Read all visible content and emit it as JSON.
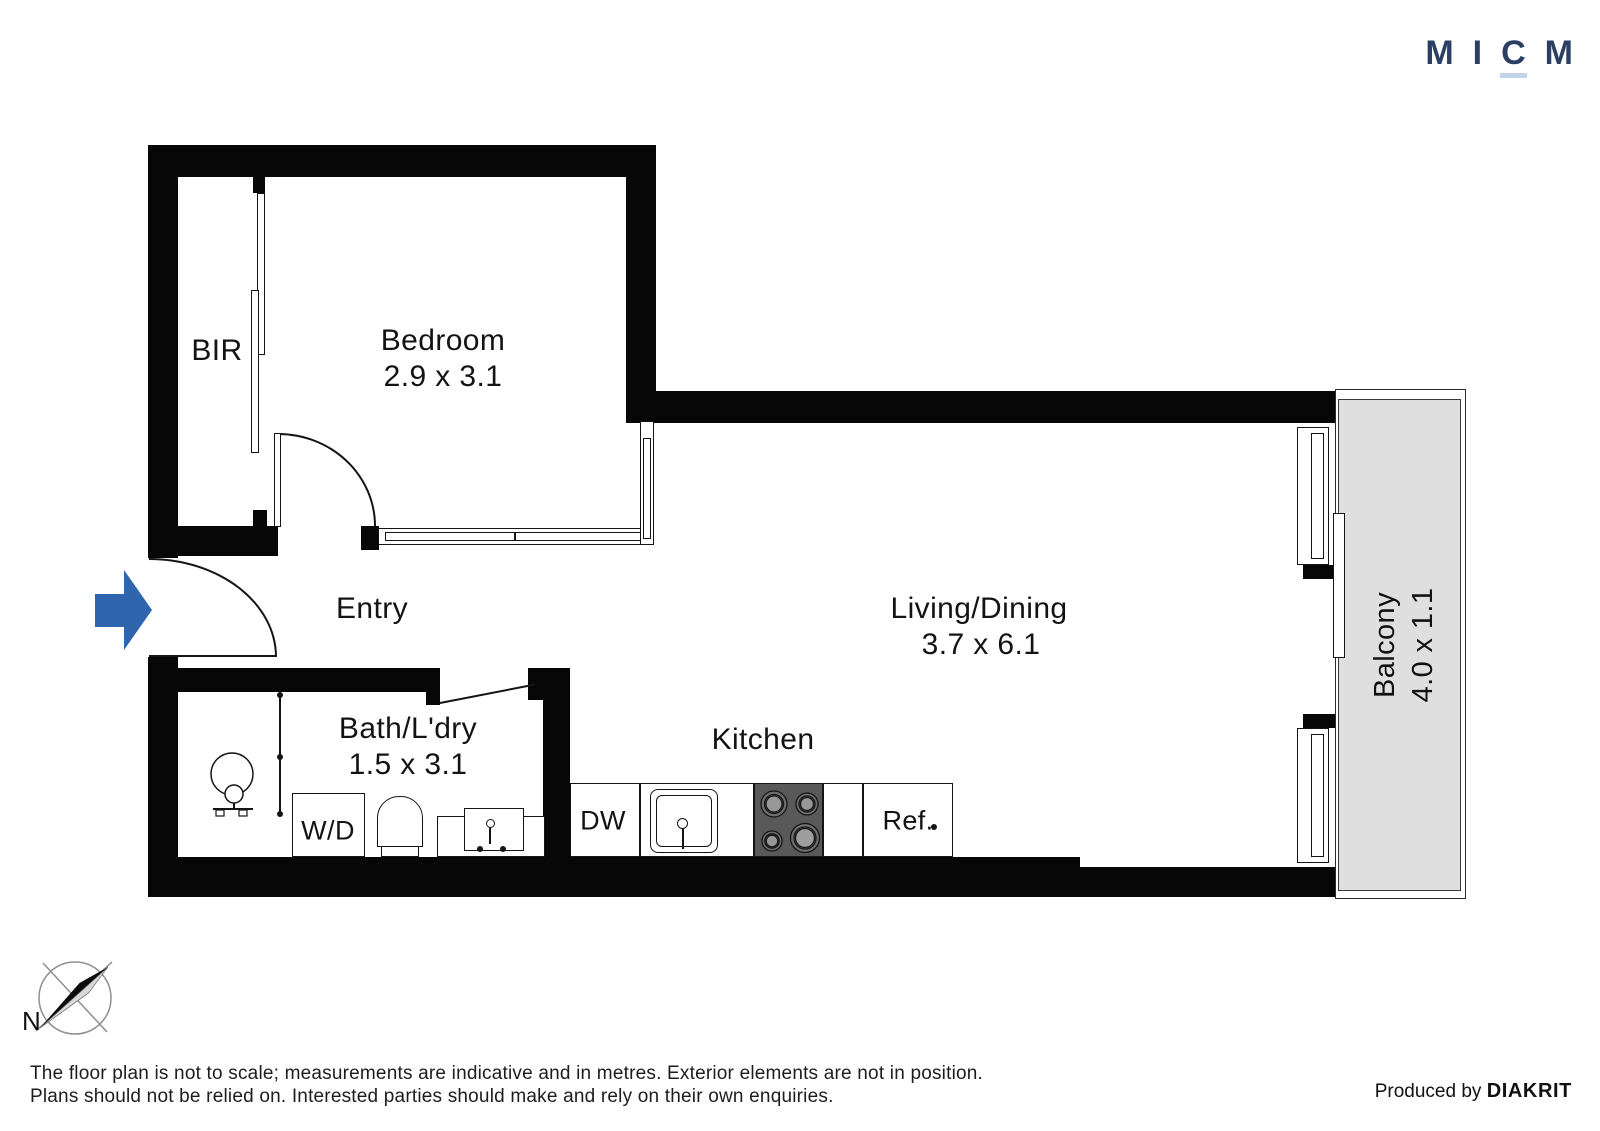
{
  "brand": {
    "logo_letters": [
      "M",
      "I",
      "C",
      "M"
    ],
    "logo_color": "#2b3f63",
    "logo_underline_color": "#c3d4ea"
  },
  "rooms": {
    "bir": {
      "name": "BIR"
    },
    "bedroom": {
      "name": "Bedroom",
      "dims": "2.9 x 3.1"
    },
    "entry": {
      "name": "Entry"
    },
    "living": {
      "name": "Living/Dining",
      "dims": "3.7 x 6.1"
    },
    "bath": {
      "name": "Bath/L'dry",
      "dims": "1.5 x 3.1"
    },
    "kitchen": {
      "name": "Kitchen"
    },
    "balcony": {
      "name": "Balcony",
      "dims": "4.0 x 1.1"
    }
  },
  "fixtures": {
    "washer_dryer": "W/D",
    "dishwasher": "DW",
    "fridge": "Ref."
  },
  "compass": {
    "north_label": "N"
  },
  "footer": {
    "disclaimer_line1": "The floor plan is not to scale; measurements are indicative and in metres. Exterior elements are not in position.",
    "disclaimer_line2": "Plans should not be relied on. Interested parties should make and rely on their own enquiries.",
    "produced_by": "Produced by ",
    "producer": "DIAKRIT"
  },
  "colors": {
    "wall": "#070707",
    "balcony_fill": "#dfdfdf",
    "stove_fill": "#595959",
    "arrow_blue": "#2e65ad"
  }
}
